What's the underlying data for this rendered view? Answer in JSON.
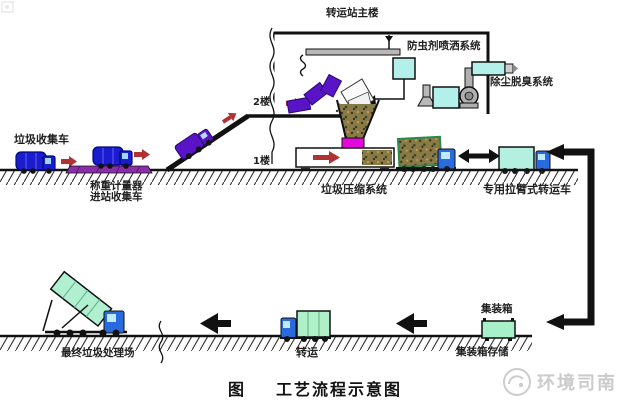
{
  "diagram": {
    "building": {
      "title": "转运站主楼",
      "floor2": "2楼",
      "floor1": "1楼"
    },
    "systems": {
      "spray": "防虫剂喷洒系统",
      "dedust": "除尘脱臭系统",
      "compression": "垃圾压缩系统"
    },
    "entry_flow": {
      "collection_truck": "垃圾收集车",
      "weighing_line1": "称重计量器",
      "weighing_line2": "进站收集车"
    },
    "transfer_flow": {
      "transfer_truck": "专用拉臂式转运车",
      "container": "集装箱",
      "container_storage": "集装箱存储",
      "transport": "转运",
      "disposal": "最终垃圾处理场"
    },
    "caption": {
      "prefix": "图",
      "title": "工艺流程示意图"
    },
    "watermark": {
      "text": "环境司南"
    },
    "colors": {
      "truck_blue": "#1c1ccf",
      "cab_blue": "#2a6adf",
      "truck_purple": "#5a14c8",
      "weighbridge_purple": "#8a2faa",
      "arrow_red": "#b03232",
      "equipment_cyan": "#b4f0ea",
      "container_cyan": "#b4f0e0",
      "container_green": "#aef0c6",
      "compressor_magenta": "#e607dc",
      "machine_gray": "#b0b0b0",
      "line_black": "#111111",
      "watermark_gray": "#cbcbcb"
    }
  }
}
